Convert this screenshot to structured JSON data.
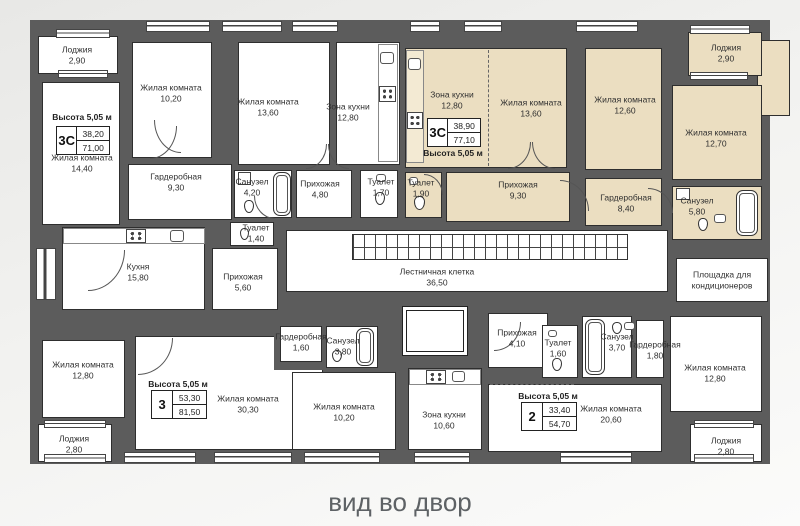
{
  "caption": "вид во двор",
  "colors": {
    "wall": "#5c5c5c",
    "room": "#ffffff",
    "highlight_apartment": "#ebdec1",
    "background": "#f2f2f0",
    "caption_text": "#5e6265"
  },
  "apartments": [
    {
      "type": "3С",
      "height_label": "Высота 5,05 м",
      "area_living": "38,20",
      "area_total": "71,00"
    },
    {
      "type": "3С",
      "height_label": "Высота 5,05 м",
      "area_living": "38,90",
      "area_total": "77,10",
      "highlighted": true
    },
    {
      "type": "3",
      "height_label": "Высота 5,05 м",
      "area_living": "53,30",
      "area_total": "81,50"
    },
    {
      "type": "2",
      "height_label": "Высота 5,05 м",
      "area_living": "33,40",
      "area_total": "54,70"
    }
  ],
  "rooms": [
    {
      "name": "Лоджия",
      "area": "2,90"
    },
    {
      "name": "Жилая комната",
      "area": "10,20"
    },
    {
      "name": "Жилая комната",
      "area": "14,40"
    },
    {
      "name": "Жилая комната",
      "area": "13,60"
    },
    {
      "name": "Зона кухни",
      "area": "12,80"
    },
    {
      "name": "Гардеробная",
      "area": "9,30"
    },
    {
      "name": "Санузел",
      "area": "4,20"
    },
    {
      "name": "Прихожая",
      "area": "4,80"
    },
    {
      "name": "Туалет",
      "area": "1,70"
    },
    {
      "name": "Зона кухни",
      "area": "12,80"
    },
    {
      "name": "Жилая комната",
      "area": "13,60"
    },
    {
      "name": "Туалет",
      "area": "1,90"
    },
    {
      "name": "Прихожая",
      "area": "9,30"
    },
    {
      "name": "Жилая комната",
      "area": "12,60"
    },
    {
      "name": "Лоджия",
      "area": "2,90"
    },
    {
      "name": "Жилая комната",
      "area": "12,70"
    },
    {
      "name": "Гардеробная",
      "area": "8,40"
    },
    {
      "name": "Санузел",
      "area": "5,80"
    },
    {
      "name": "Кухня",
      "area": "15,80"
    },
    {
      "name": "Туалет",
      "area": "1,40"
    },
    {
      "name": "Прихожая",
      "area": "5,60"
    },
    {
      "name": "Лестничная клетка",
      "area": "36,50"
    },
    {
      "name": "Площадка для кондиционеров",
      "area": ""
    },
    {
      "name": "Жилая комната",
      "area": "12,80"
    },
    {
      "name": "Лоджия",
      "area": "2,80"
    },
    {
      "name": "Жилая комната",
      "area": "30,30"
    },
    {
      "name": "Гардеробная",
      "area": "1,60"
    },
    {
      "name": "Санузел",
      "area": "3,80"
    },
    {
      "name": "Жилая комната",
      "area": "10,20"
    },
    {
      "name": "Зона кухни",
      "area": "10,60"
    },
    {
      "name": "Прихожая",
      "area": "4,10"
    },
    {
      "name": "Туалет",
      "area": "1,60"
    },
    {
      "name": "Санузел",
      "area": "3,70"
    },
    {
      "name": "Гардеробная",
      "area": "1,80"
    },
    {
      "name": "Жилая комната",
      "area": "20,60"
    },
    {
      "name": "Жилая комната",
      "area": "12,80"
    },
    {
      "name": "Лоджия",
      "area": "2,80"
    }
  ]
}
